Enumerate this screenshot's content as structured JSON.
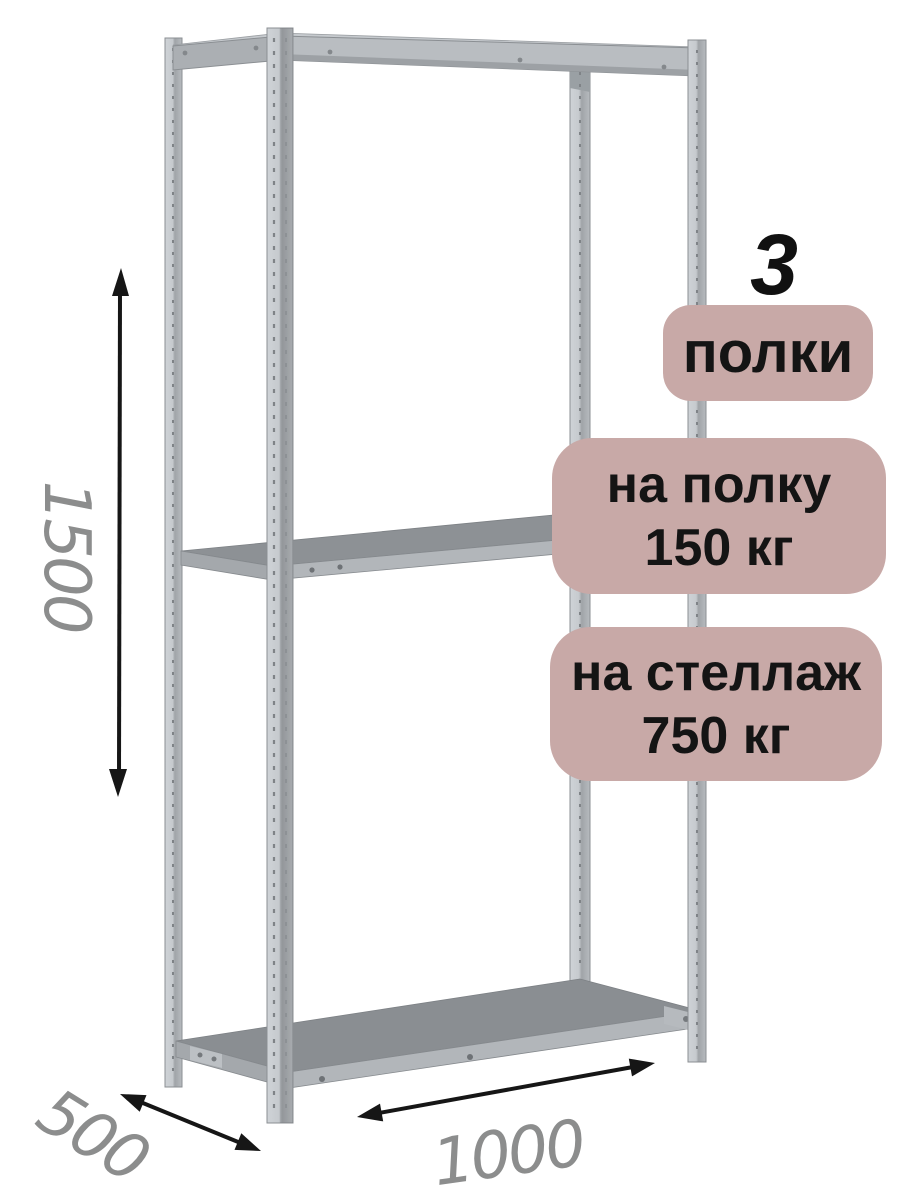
{
  "badges": {
    "shelves_count": "3",
    "shelves_label": "полки",
    "shelf_load_line1": "на полку",
    "shelf_load_line2": "150 кг",
    "rack_load_line1": "на стеллаж",
    "rack_load_line2": "750 кг"
  },
  "dimensions": {
    "height_mm": "1500",
    "depth_mm": "500",
    "width_mm": "1000"
  },
  "colors": {
    "badge-bg": "#c8a9a7",
    "badge-text": "#141414",
    "count-text": "#111111",
    "dim-text": "#8c8d8d",
    "arrow": "#161616",
    "metal-light": "#d5d9dd",
    "metal-mid": "#b9bdc1",
    "metal-edge": "#8b8f93",
    "shelf-top": "#8d9195",
    "shelf-front": "#b2b6ba",
    "bg": "#ffffff"
  }
}
